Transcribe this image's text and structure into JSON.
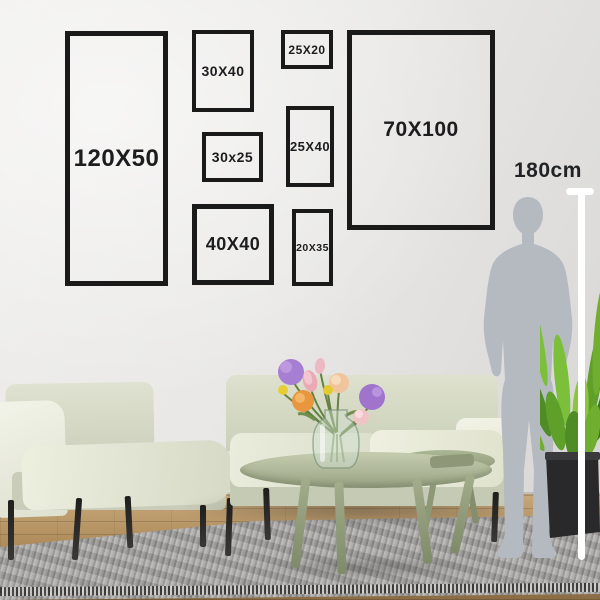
{
  "frames": [
    {
      "id": "frame-120x50",
      "label": "120X50"
    },
    {
      "id": "frame-30x40",
      "label": "30X40"
    },
    {
      "id": "frame-25x20",
      "label": "25X20"
    },
    {
      "id": "frame-30x25",
      "label": "30x25"
    },
    {
      "id": "frame-25x40",
      "label": "25X40"
    },
    {
      "id": "frame-70x100",
      "label": "70X100"
    },
    {
      "id": "frame-40x40",
      "label": "40X40"
    },
    {
      "id": "frame-20x35",
      "label": "20X35"
    }
  ],
  "ruler": {
    "height_label": "180cm"
  },
  "colors": {
    "frame_border": "#1a1a1a",
    "label_text": "#1d1d1f",
    "wall": "#e8e7e5",
    "silhouette": "#b6bac1",
    "ruler_line": "#ffffff",
    "sofa": "#dde1cd",
    "armchair": "#e6e9d8",
    "table": "#a9b394",
    "rug": "#a09f9d",
    "floor_wood": "#b3905f",
    "plant_green": "#6fae2e",
    "flower_purple": "#a77fd2",
    "flower_orange": "#e8973f",
    "flower_pink": "#e9aab6",
    "flower_yellow": "#e6cf35"
  }
}
